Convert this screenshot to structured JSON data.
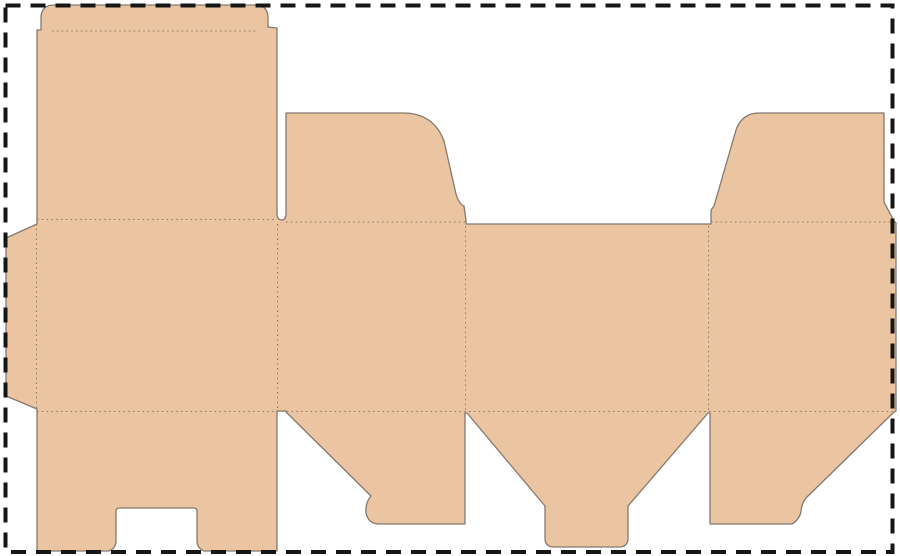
{
  "canvas": {
    "width": 900,
    "height": 556,
    "background_color": "#ffffff"
  },
  "colors": {
    "board_fill": "#ebc4a2",
    "cut_line": "#85796e",
    "fold_line": "#967d66",
    "border_line": "#161616"
  },
  "border": {
    "x": 5.5,
    "y": 5.5,
    "width": 887,
    "height": 546.5,
    "thickness": 4,
    "dash_pattern": "15 10"
  },
  "dieline": {
    "kind": "carton-box-dieline",
    "outline_path": "M54,5 L255,5 Q268,5 268,18 L268,27 L277,28 L277,213 Q277,220 281.5,220 Q286,220 286,213 L286,113 L405,113 Q434,114 444,141 L456,194 Q459,204 464,206 L466,220 L466,224 L711,224 L711,210 L714,206 L736,130 Q742,113 759,113 L884,113 L884,202 L894,221 L896,223 L896,411 L893,413 L807,497 Q802,502 801,511 Q800,519 792,524 L710,524 L710,413 L708,413 L628,506 L628,538 Q628,547 619,547 L554,547 Q545,547 545,538 L545,506 L467,413 L465,413 L465,524 L378,524 Q368,523 366,513 Q365,503 371,496 L286,412 L286,411 L277,411 L277,551 L204,551 Q197,548 197,541 L197,511 Q197,508 193,508 L120,508 Q116,508 116,511 L116,541 Q116,548 109,551 L37,551 L37,409 L6,396 L6,238 L37,224 L37,30 L41,30 L41,18 Q41,5 54,5 Z",
    "outline_stroke_width": 1.3,
    "fold_stroke_width": 1,
    "fold_dash_pattern": "1.6 3.2",
    "fold_lines": [
      {
        "name": "tuck-flap-fold",
        "x1": 52,
        "y1": 31,
        "x2": 257,
        "y2": 31
      },
      {
        "name": "lid-top-fold",
        "x1": 37,
        "y1": 219.5,
        "x2": 277,
        "y2": 219.5
      },
      {
        "name": "dust-flap-1-fold",
        "x1": 286,
        "y1": 222,
        "x2": 466,
        "y2": 222
      },
      {
        "name": "dust-flap-2-fold",
        "x1": 711,
        "y1": 222,
        "x2": 894,
        "y2": 222
      },
      {
        "name": "bottom-flaps-fold",
        "x1": 37,
        "y1": 411.5,
        "x2": 893,
        "y2": 411.5
      },
      {
        "name": "glue-flap-fold",
        "x1": 36.5,
        "y1": 224,
        "x2": 36.5,
        "y2": 409
      },
      {
        "name": "panel-a-b-fold",
        "x1": 277.5,
        "y1": 224,
        "x2": 277.5,
        "y2": 411
      },
      {
        "name": "panel-b-c-fold",
        "x1": 465.5,
        "y1": 226,
        "x2": 465.5,
        "y2": 411
      },
      {
        "name": "panel-c-d-fold",
        "x1": 708.5,
        "y1": 226,
        "x2": 708.5,
        "y2": 411
      }
    ]
  }
}
